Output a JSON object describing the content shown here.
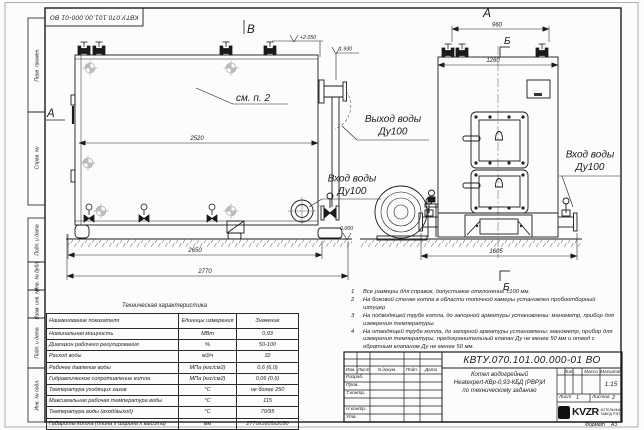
{
  "stamps": {
    "top_left": "КВТУ.070.101.00.000-01 ВО",
    "margin": [
      "Перв. примен.",
      "Справ. №",
      "Подп. и дата",
      "Инв. № дубл.",
      "Взам. инв. №",
      "Подп. и дата",
      "Инв. № подл."
    ]
  },
  "drawing": {
    "view_labels": {
      "a_left": "А",
      "v_top": "В",
      "a_top": "А",
      "b_top": "Б",
      "b_bottom": "Б"
    },
    "callout_see_p2": "см. п. 2",
    "elevations": {
      "top": "+2.050",
      "mid": "1.930",
      "zero": "0.000"
    },
    "dimensions": {
      "len_body": "2520",
      "len_mid": "2650",
      "len_total": "2770",
      "front_top": "960",
      "front_width": "1260",
      "front_total": "1605"
    },
    "labels": {
      "outlet_line1": "Выход воды",
      "outlet_line2": "Ду100",
      "inlet_left_line1": "Вход воды",
      "inlet_left_line2": "Ду100",
      "inlet_right_line1": "Вход воды",
      "inlet_right_line2": "Ду100"
    }
  },
  "notes": {
    "items": [
      {
        "num": "1",
        "text": "Все размеры для справок, допустимое отклонение ±100 мм."
      },
      {
        "num": "2",
        "text": "На боковой стенке котла в области топочной камеры установлен пробоотборный штуцер"
      },
      {
        "num": "3",
        "text": "На подводящей трубе котла, до запорной арматуры установлены: манометр, прибор для измерения температуры."
      },
      {
        "num": "4",
        "text": "На отводящей трубе котла, до запорной арматуры установлены: манометр, прибор для измерения температуры, предохранительный клапан Ду не менее 50 мм и отвод с обратным клапаном Ду не менее 50 мм."
      }
    ]
  },
  "tech_table": {
    "title": "Техническая характеристика",
    "col_name": "Наименование показателя",
    "col_units": "Единицы измерения",
    "col_value": "Значение",
    "rows": [
      {
        "name": "Номинальная мощность",
        "units": "МВт",
        "value": "0,93"
      },
      {
        "name": "Диапазон рабочего регулирования",
        "units": "%",
        "value": "50-100"
      },
      {
        "name": "Расход воды",
        "units": "м3/ч",
        "value": "32"
      },
      {
        "name": "Рабочее давление воды",
        "units": "МПа (кгс/см2)",
        "value": "0,6 (6,0)"
      },
      {
        "name": "Гидравлическое сопротивление котла",
        "units": "МПа (кгс/см2)",
        "value": "0,06 (0,6)"
      },
      {
        "name": "Температура уходящих газов",
        "units": "°С",
        "value": "не более 250"
      },
      {
        "name": "Максимальная рабочая температура воды",
        "units": "°С",
        "value": "115"
      },
      {
        "name": "Температура воды (вход/выход)",
        "units": "°С",
        "value": "70/95"
      },
      {
        "name": "Габариты котла (длина х ширина х высота)",
        "units": "мм",
        "value": "2770х1605х2050"
      }
    ]
  },
  "title_block": {
    "designation": "КВТУ.070.101.00.000-01 ВО",
    "doc_name_line1": "Котел водогрейный",
    "doc_name_line2": "Heatexpert-КВр-0,93-КБД (РВР)И",
    "doc_name_line3": "по техническому заданию",
    "header_cols": [
      "Изм.",
      "Лист",
      "N докум.",
      "Подп.",
      "Дата"
    ],
    "sig_rows": [
      "Разраб.",
      "Пров.",
      "Т.контр.",
      "",
      "Н.контр.",
      "Утв."
    ],
    "lit_label": "Лит.",
    "mass_label": "Масса",
    "scale_label": "Масштаб",
    "scale_value": "1:15",
    "sheet_label": "Лист",
    "sheet_value": "1",
    "sheets_label": "Листов",
    "sheets_value": "2",
    "logo_text": "KVZR",
    "logo_sub1": "КОТЕЛЬНЫЙ",
    "logo_sub2": "ЗАВОД РЭП",
    "format_label": "Формат",
    "format_value": "А3"
  }
}
